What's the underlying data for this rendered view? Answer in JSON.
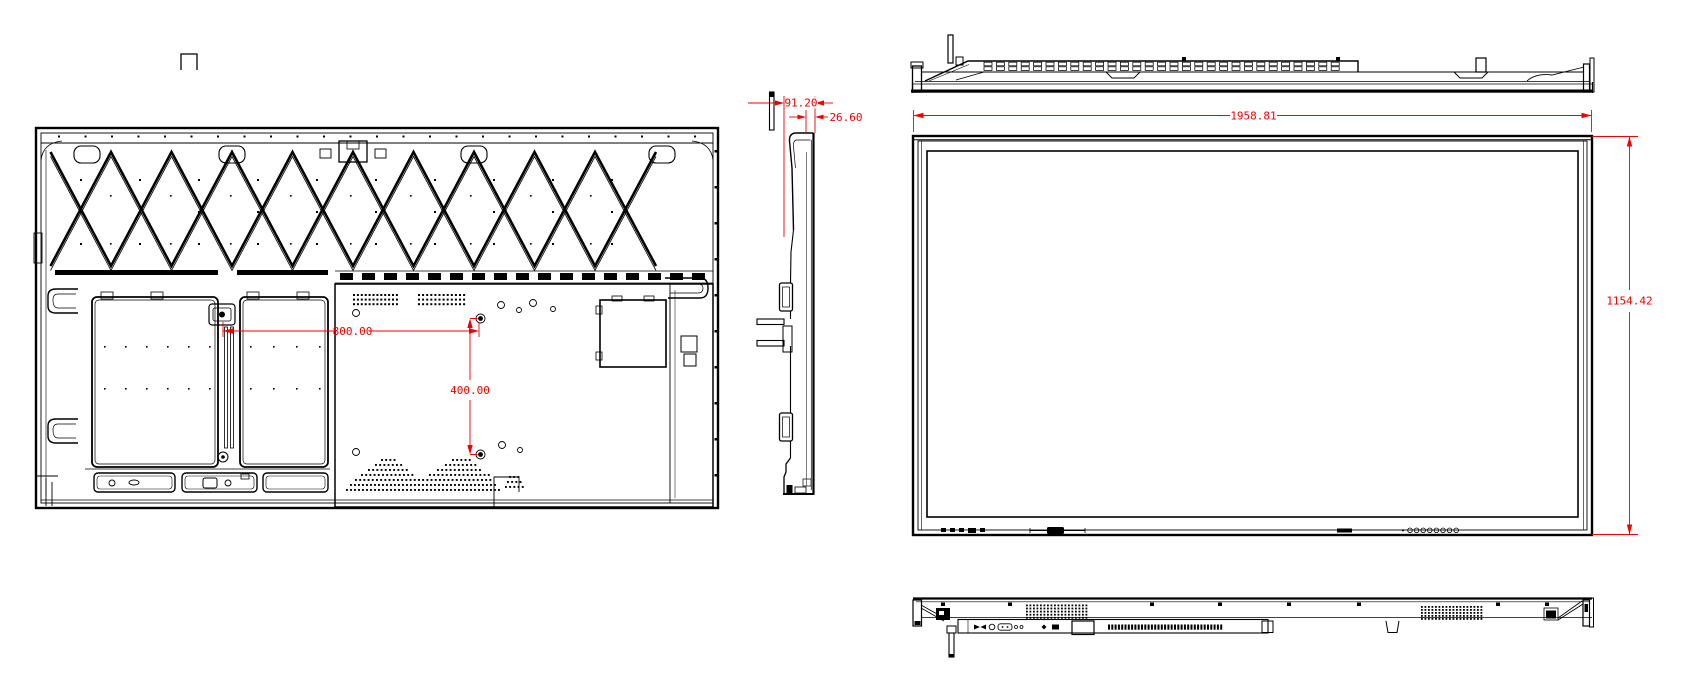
{
  "colors": {
    "line": "#000000",
    "dimension": "#f10000",
    "background": "#ffffff"
  },
  "views": {
    "rear": {
      "name": "rear-view"
    },
    "side": {
      "name": "side-view"
    },
    "top": {
      "name": "top-view"
    },
    "front": {
      "name": "front-view"
    },
    "bottom": {
      "name": "bottom-view"
    }
  },
  "dimensions": {
    "vesa_width": "800.00",
    "vesa_height": "400.00",
    "depth_overall": "91.20",
    "depth_front": "26.60",
    "overall_width": "1958.81",
    "overall_height": "1154.42"
  }
}
